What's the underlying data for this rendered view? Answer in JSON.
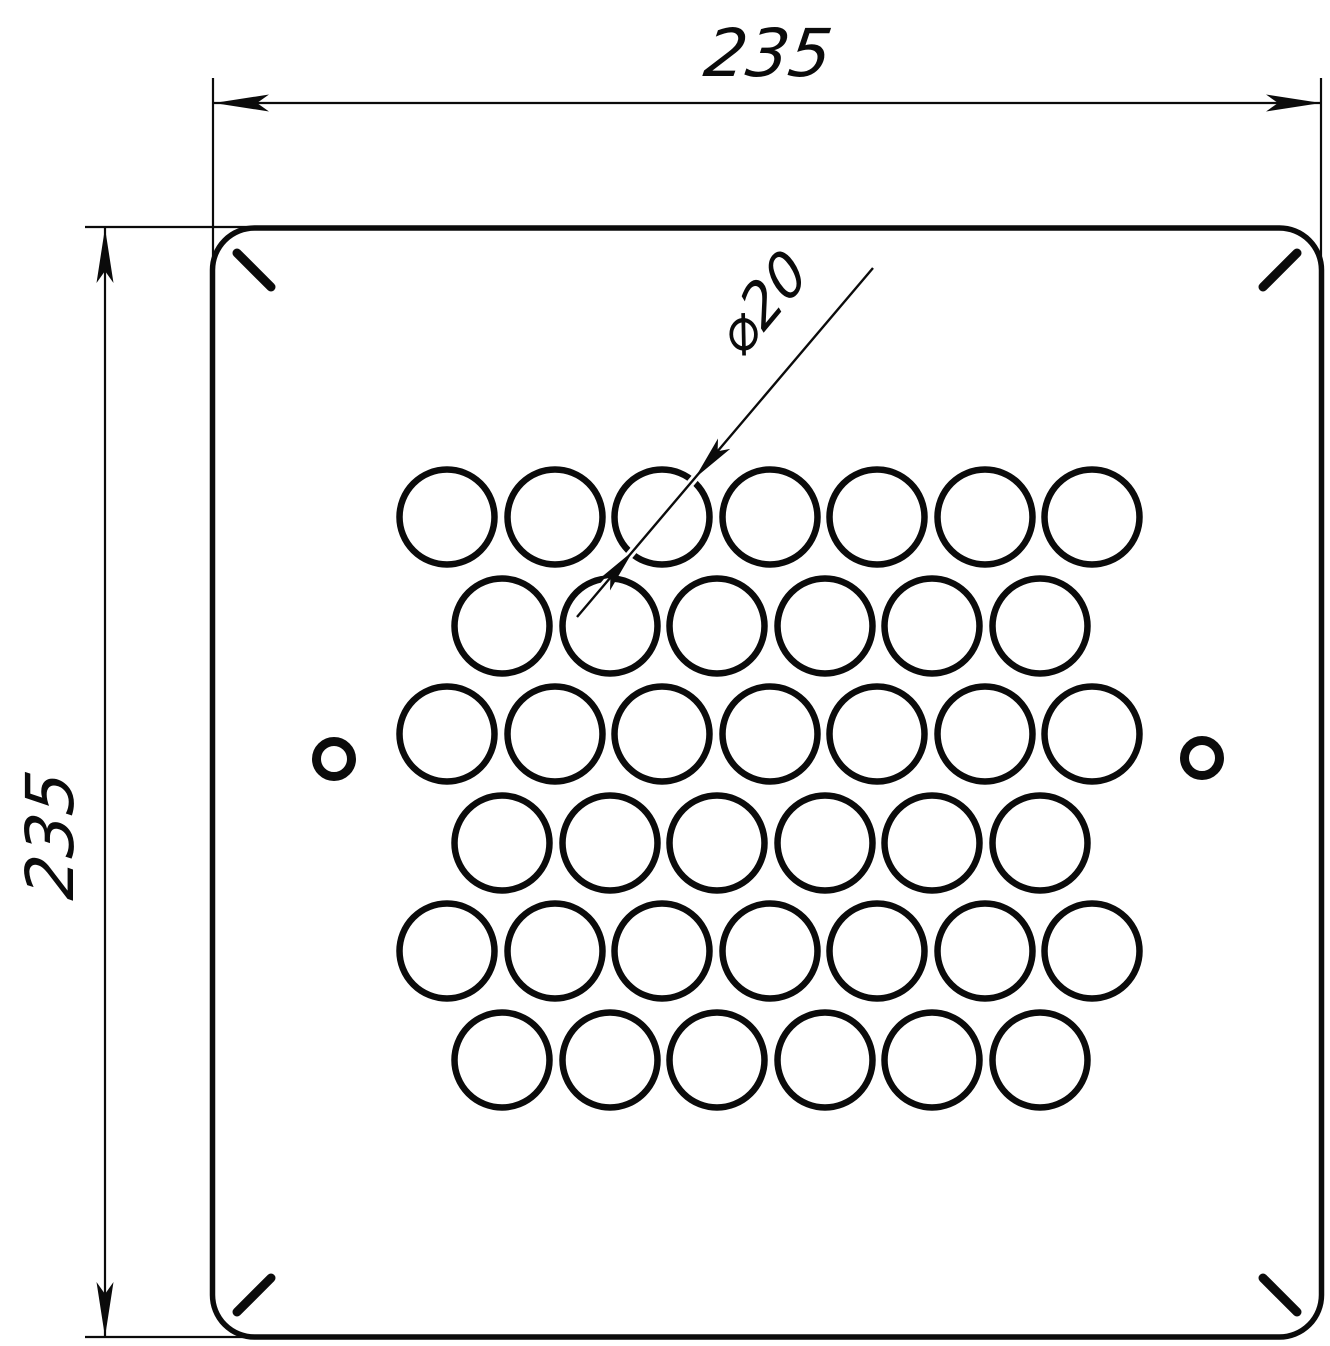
{
  "drawing": {
    "type": "mechanical-part-drawing",
    "part": "square perforated plate, rounded corners",
    "background_color": "#ffffff",
    "line_color": "#0b0b0b",
    "dimensions": {
      "top_width_label": "235",
      "left_height_label": "235",
      "hole_diameter_label": "⌀20"
    },
    "holes": {
      "large_hole_rows": [
        7,
        6,
        7,
        6,
        7,
        6
      ],
      "large_hole_total": 39,
      "side_mounting_holes": 2
    }
  }
}
